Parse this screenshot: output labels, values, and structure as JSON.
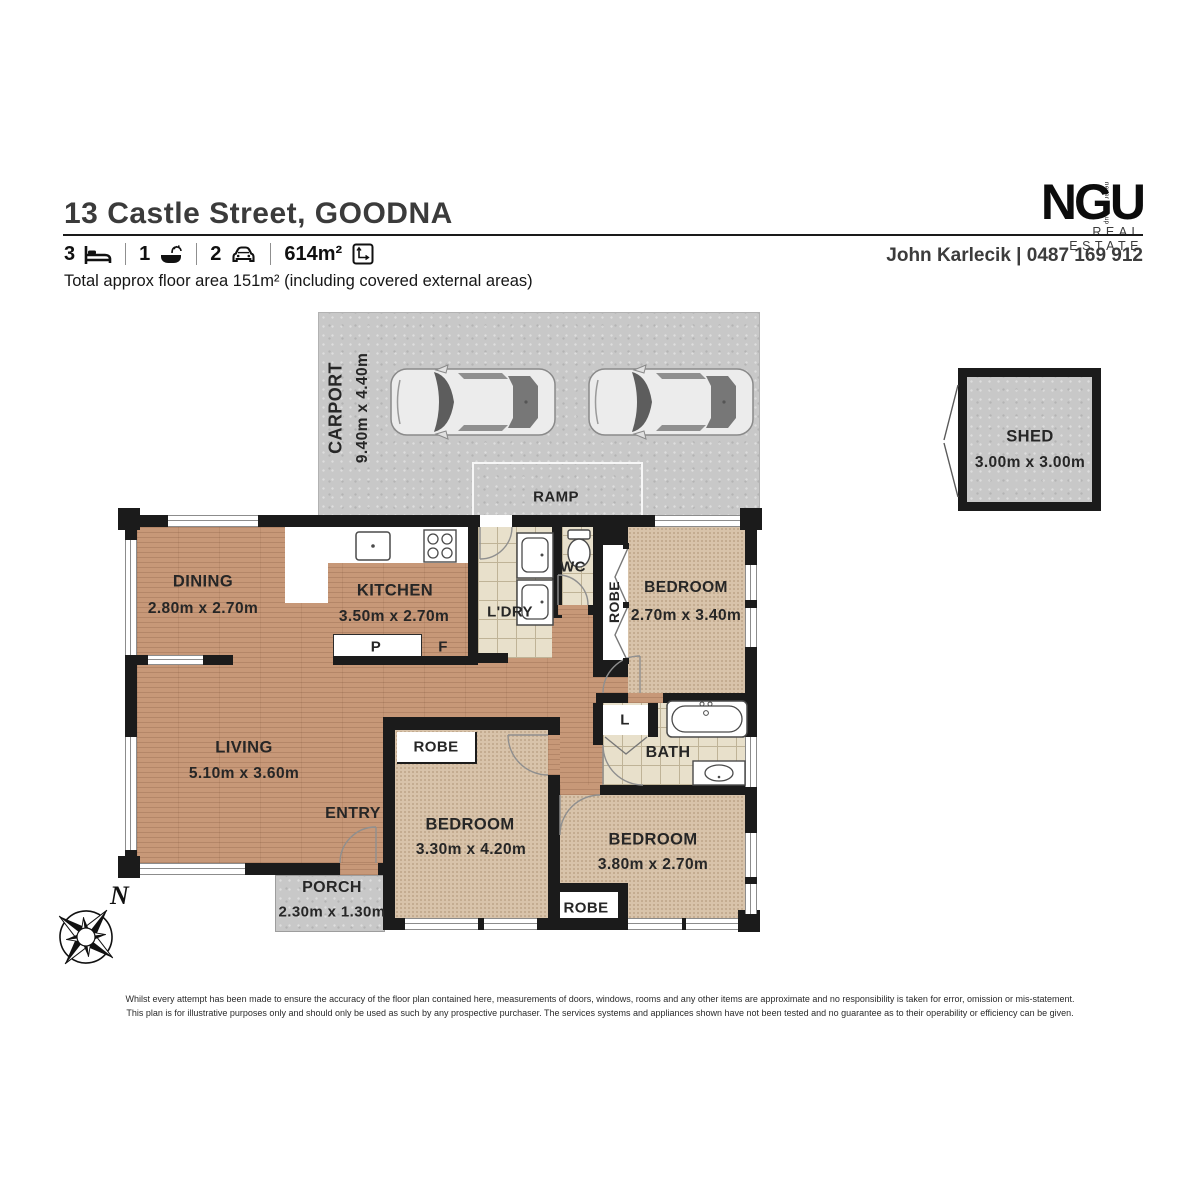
{
  "header": {
    "title": "13 Castle Street, GOODNA",
    "stats": {
      "beds": "3",
      "baths": "1",
      "cars": "2",
      "land": "614m²"
    },
    "floor_area_note": "Total approx floor area 151m² (including covered external areas)",
    "agent": "John Karlecik | 0487 169 912",
    "logo": {
      "name": "NGU",
      "tagline": "never give up",
      "subtitle": "REAL ESTATE"
    }
  },
  "plan": {
    "carport": {
      "name": "CARPORT",
      "dims": "9.40m x 4.40m"
    },
    "ramp": {
      "name": "RAMP"
    },
    "shed": {
      "name": "SHED",
      "dims": "3.00m x 3.00m"
    },
    "dining": {
      "name": "DINING",
      "dims": "2.80m x 2.70m"
    },
    "kitchen": {
      "name": "KITCHEN",
      "dims": "3.50m x 2.70m",
      "pantry": "P",
      "fridge": "F"
    },
    "laundry": {
      "name": "L'DRY"
    },
    "wc": {
      "name": "WC"
    },
    "robe1": {
      "name": "ROBE"
    },
    "bedroom1": {
      "name": "BEDROOM",
      "dims": "2.70m x 3.40m"
    },
    "living": {
      "name": "LIVING",
      "dims": "5.10m x 3.60m"
    },
    "entry": {
      "name": "ENTRY"
    },
    "linen": {
      "name": "L"
    },
    "bath": {
      "name": "BATH"
    },
    "bedroom2": {
      "name": "BEDROOM",
      "dims": "3.30m x 4.20m"
    },
    "robe2": {
      "name": "ROBE"
    },
    "bedroom3": {
      "name": "BEDROOM",
      "dims": "3.80m x 2.70m"
    },
    "robe3": {
      "name": "ROBE"
    },
    "porch": {
      "name": "PORCH",
      "dims": "2.30m x 1.30m"
    },
    "compass": {
      "north": "N"
    }
  },
  "disclaimer": {
    "line1": "Whilst every attempt has been made to ensure the accuracy of the floor plan contained here, measurements of doors, windows, rooms and any other items are approximate and no responsibility is taken for error, omission or mis-statement.",
    "line2": "This plan is for illustrative purposes only and should only be used as such by any prospective purchaser. The services systems and appliances shown have not been tested and no guarantee as to their operability or efficiency can be given."
  }
}
